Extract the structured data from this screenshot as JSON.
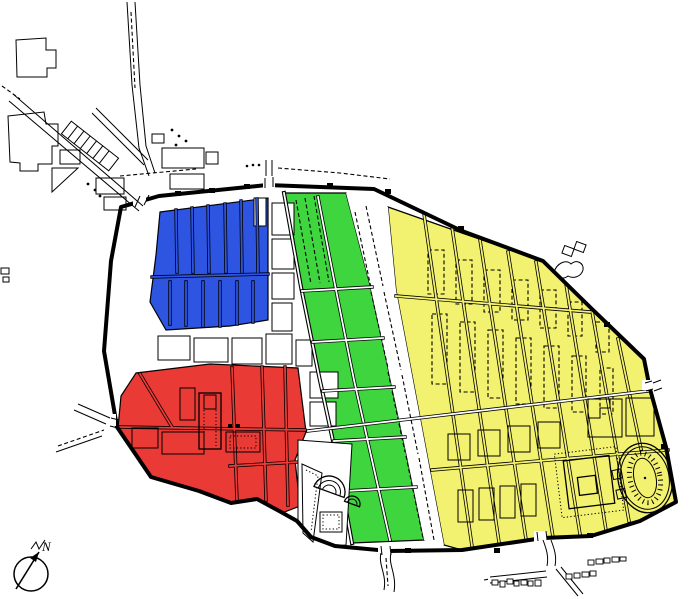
{
  "compass": {
    "label": "N"
  },
  "colors": {
    "blue": "#2E55E2",
    "green": "#3FD53F",
    "yellow": "#F3F170",
    "red": "#E93A36",
    "wall": "#000000",
    "background": "#FFFFFF"
  },
  "zones": [
    {
      "id": "northwest-district",
      "color": "blue"
    },
    {
      "id": "central-district",
      "color": "green"
    },
    {
      "id": "eastern-district",
      "color": "yellow"
    },
    {
      "id": "forum-district",
      "color": "red"
    }
  ],
  "landmarks": [
    "city-wall",
    "amphitheatre",
    "great-palaestra",
    "large-theatre",
    "odeon",
    "triangular-forum",
    "forum",
    "northwest-suburban-roads",
    "southeast-necropolis",
    "compass-rose"
  ]
}
